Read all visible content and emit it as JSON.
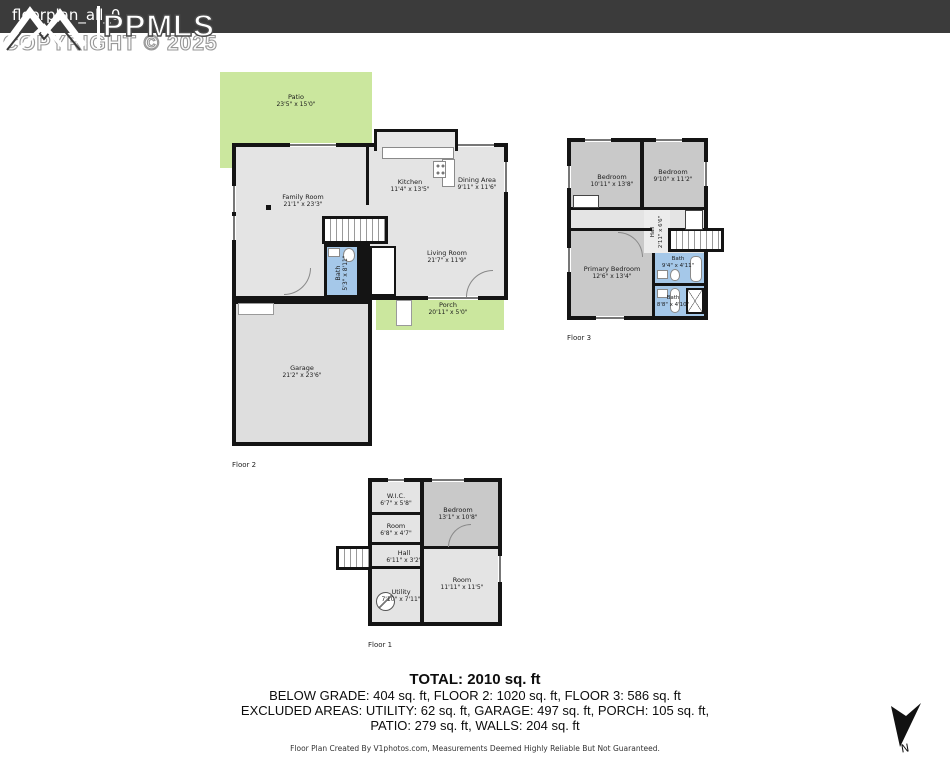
{
  "header": {
    "filename": "floorplan_all_0",
    "logo_text": "PPMLS",
    "copyright": "COPYRIGHT © 2025"
  },
  "floor2": {
    "label": "Floor 2",
    "rooms": {
      "patio": {
        "name": "Patio",
        "dims": "23'5\" x 15'0\""
      },
      "family": {
        "name": "Family Room",
        "dims": "21'1\" x 23'3\""
      },
      "kitchen": {
        "name": "Kitchen",
        "dims": "11'4\" x 13'5\""
      },
      "dining": {
        "name": "Dining Area",
        "dims": "9'11\" x 11'6\""
      },
      "living": {
        "name": "Living Room",
        "dims": "21'7\" x 11'9\""
      },
      "bath": {
        "name": "Bath",
        "dims": "5'3\" x 8'11\""
      },
      "porch": {
        "name": "Porch",
        "dims": "20'11\" x 5'0\""
      },
      "garage": {
        "name": "Garage",
        "dims": "21'2\" x 23'6\""
      }
    }
  },
  "floor3": {
    "label": "Floor 3",
    "rooms": {
      "bedroom_left": {
        "name": "Bedroom",
        "dims": "10'11\" x 13'8\""
      },
      "bedroom_right": {
        "name": "Bedroom",
        "dims": "9'10\" x 11'2\""
      },
      "hall": {
        "name": "Hall",
        "dims": "2'11\" x 6'6\""
      },
      "primary": {
        "name": "Primary Bedroom",
        "dims": "12'6\" x 13'4\""
      },
      "bath_top": {
        "name": "Bath",
        "dims": "9'4\" x 4'11\""
      },
      "bath_bottom": {
        "name": "Bath",
        "dims": "8'8\" x 4'10\""
      }
    }
  },
  "floor1": {
    "label": "Floor 1",
    "rooms": {
      "wic": {
        "name": "W.I.C.",
        "dims": "6'7\" x 5'8\""
      },
      "bedroom": {
        "name": "Bedroom",
        "dims": "13'1\" x 10'8\""
      },
      "room1": {
        "name": "Room",
        "dims": "6'8\" x 4'7\""
      },
      "hall": {
        "name": "Hall",
        "dims": "6'11\" x 3'2\""
      },
      "utility": {
        "name": "Utility",
        "dims": "7'10\" x 7'11\""
      },
      "room2": {
        "name": "Room",
        "dims": "11'11\" x 11'5\""
      }
    }
  },
  "summary": {
    "total": "TOTAL: 2010 sq. ft",
    "line2": "BELOW GRADE: 404 sq. ft, FLOOR 2: 1020 sq. ft, FLOOR 3: 586 sq. ft",
    "line3": "EXCLUDED AREAS: UTILITY: 62 sq. ft, GARAGE: 497 sq. ft, PORCH: 105 sq. ft,",
    "line4": "PATIO: 279 sq. ft, WALLS: 204 sq. ft",
    "disclaimer": "Floor Plan Created By V1photos.com, Measurements Deemed Highly Reliable But Not Guaranteed."
  },
  "compass": {
    "label": "N"
  },
  "colors": {
    "header_bar": "#3b3b3b",
    "patio_green": "#cbe79e",
    "bath_blue": "#a5c8e9",
    "room_gray": "#e4e4e4",
    "bedroom_gray": "#c9c9c9",
    "wall_black": "#141414"
  }
}
